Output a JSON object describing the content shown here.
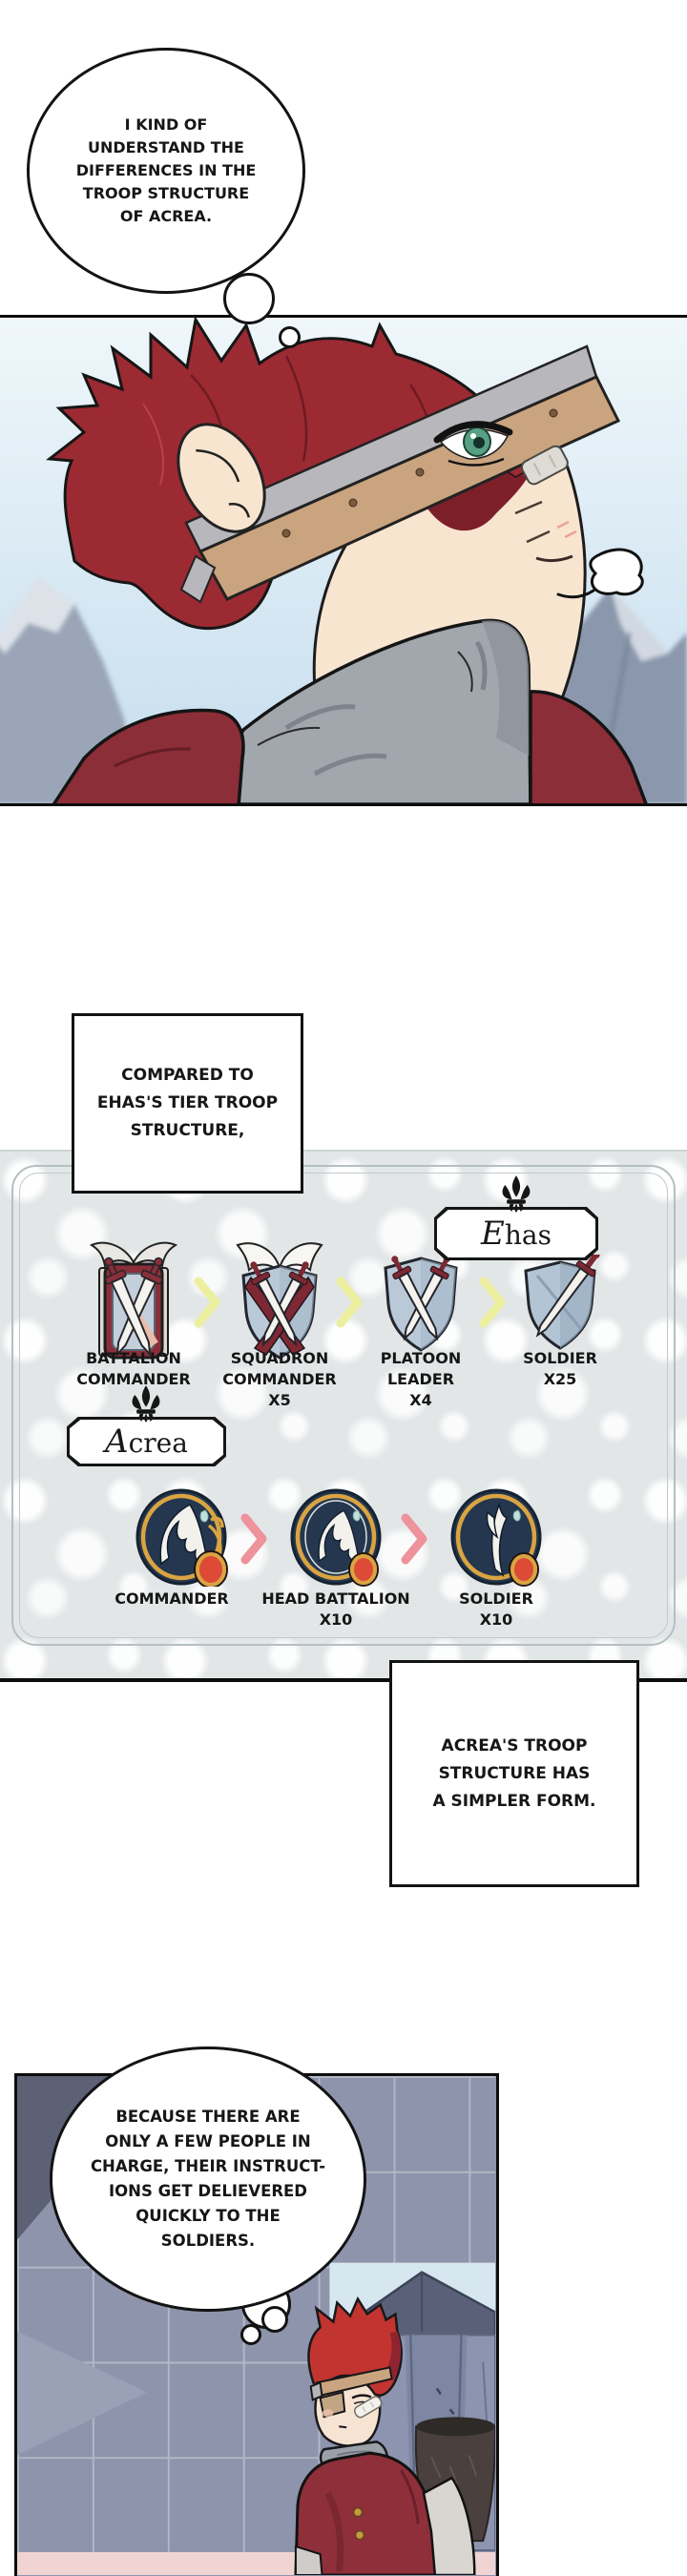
{
  "bubble1": {
    "lines": [
      "I KIND OF",
      "UNDERSTAND THE",
      "DIFFERENCES IN THE",
      "TROOP STRUCTURE",
      "OF ACREA."
    ]
  },
  "box_compared": {
    "lines": [
      "COMPARED TO",
      "EHAS'S TIER TROOP",
      "STRUCTURE,"
    ]
  },
  "diagram": {
    "ehas_label": "Ehas",
    "acrea_label": "Acrea",
    "ehas_units": [
      {
        "icon": "winged-ornate-shield",
        "lines": [
          "BATTALION",
          "COMMANDER"
        ]
      },
      {
        "icon": "winged-crossed-swords-shield",
        "lines": [
          "SQUADRON",
          "COMMANDER",
          "X5"
        ]
      },
      {
        "icon": "crossed-swords-shield",
        "lines": [
          "PLATOON",
          "LEADER",
          "X4"
        ]
      },
      {
        "icon": "single-sword-shield",
        "lines": [
          "SOLDIER",
          "X25"
        ]
      }
    ],
    "acrea_units": [
      {
        "icon": "ornate-wing-emblem",
        "lines": [
          "COMMANDER"
        ]
      },
      {
        "icon": "ringed-wing-emblem",
        "lines": [
          "HEAD BATTALION",
          "X10"
        ]
      },
      {
        "icon": "plain-wing-emblem",
        "lines": [
          "SOLDIER",
          "X10"
        ]
      }
    ],
    "colors": {
      "arrow_yellow": "#ecefa0",
      "arrow_pink": "#ee929b",
      "pattern_bg": "#e2e6e7",
      "shield_maroon": "#7e2833",
      "emblem_navy": "#24374f",
      "emblem_gold": "#d9a441",
      "gem_red": "#dd4a36"
    }
  },
  "box_acrea": {
    "lines": [
      "ACREA'S TROOP",
      "STRUCTURE HAS",
      "A SIMPLER FORM."
    ]
  },
  "bubble2": {
    "lines": [
      "BECAUSE THERE ARE",
      "ONLY A FEW PEOPLE IN",
      "CHARGE, THEIR INSTRUCT-",
      "IONS GET DELIEVERED",
      "QUICKLY TO THE",
      "SOLDIERS."
    ]
  }
}
